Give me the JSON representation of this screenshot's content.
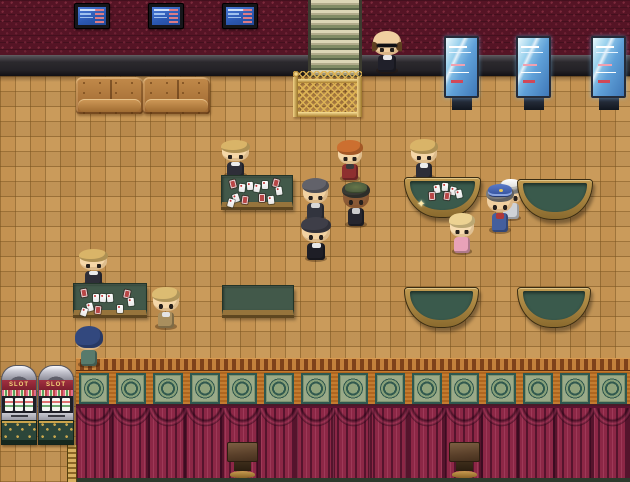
{
  "scene": {
    "width": 630,
    "height": 482
  },
  "labels": {
    "slot": "SLOT",
    "sparkle": "✦"
  },
  "palette": {
    "wall": "#551425",
    "floor": "#c49251",
    "curtain": "#8c2746",
    "table_felt": "#42594a",
    "gold_trim": "#c9a34c",
    "entrance_green": "#76815c",
    "entrance_cream": "#d8d2b2",
    "screen_blue": "#3a6fd8"
  },
  "fixtures": {
    "tvs": [
      {
        "x": 74,
        "y": 3
      },
      {
        "x": 148,
        "y": 3
      },
      {
        "x": 222,
        "y": 3
      }
    ],
    "tv_size": {
      "w": 36,
      "h": 26
    },
    "kiosks": [
      {
        "x": 444,
        "y": 36
      },
      {
        "x": 516,
        "y": 36
      },
      {
        "x": 591,
        "y": 36
      }
    ],
    "kiosk_size": {
      "w": 35,
      "h": 76
    },
    "couches": [
      {
        "x": 76,
        "y": 77
      },
      {
        "x": 143,
        "y": 77
      }
    ],
    "couch_size": {
      "w": 67,
      "h": 37
    },
    "slot_machines": [
      {
        "x": 1,
        "y": 365
      },
      {
        "x": 38,
        "y": 365
      }
    ],
    "slot_size": {
      "w": 36,
      "h": 80
    },
    "podiums": [
      {
        "x": 227,
        "y": 442
      },
      {
        "x": 449,
        "y": 442
      }
    ],
    "podium_size": {
      "w": 31,
      "h": 36
    },
    "frieze_panels": 15
  },
  "tables": [
    {
      "id": "card-table-north",
      "type": "rect",
      "x": 221,
      "y": 175,
      "w": 72,
      "h": 32,
      "cards": [
        {
          "x": 8,
          "y": 4,
          "c": "r",
          "rot": -14
        },
        {
          "x": 17,
          "y": 8,
          "c": "w",
          "rot": 6
        },
        {
          "x": 25,
          "y": 6,
          "c": "w",
          "rot": -4
        },
        {
          "x": 32,
          "y": 8,
          "c": "w",
          "rot": 10
        },
        {
          "x": 40,
          "y": 5,
          "c": "w",
          "rot": 0
        },
        {
          "x": 51,
          "y": 3,
          "c": "r",
          "rot": 14
        },
        {
          "x": 54,
          "y": 11,
          "c": "w",
          "rot": -8
        },
        {
          "x": 11,
          "y": 18,
          "c": "w",
          "rot": -18
        },
        {
          "x": 20,
          "y": 20,
          "c": "r",
          "rot": 8
        },
        {
          "x": 37,
          "y": 18,
          "c": "r",
          "rot": 0
        },
        {
          "x": 6,
          "y": 23,
          "c": "w",
          "rot": 16
        },
        {
          "x": 46,
          "y": 20,
          "c": "w",
          "rot": -6
        }
      ]
    },
    {
      "id": "card-table-south",
      "type": "rect",
      "x": 73,
      "y": 283,
      "w": 74,
      "h": 32,
      "cards": [
        {
          "x": 7,
          "y": 5,
          "c": "r",
          "rot": -10
        },
        {
          "x": 19,
          "y": 10,
          "c": "w",
          "rot": 0
        },
        {
          "x": 26,
          "y": 10,
          "c": "w",
          "rot": 4
        },
        {
          "x": 33,
          "y": 10,
          "c": "w",
          "rot": -4
        },
        {
          "x": 50,
          "y": 6,
          "c": "r",
          "rot": 12
        },
        {
          "x": 54,
          "y": 14,
          "c": "w",
          "rot": -6
        },
        {
          "x": 13,
          "y": 19,
          "c": "w",
          "rot": -14
        },
        {
          "x": 21,
          "y": 22,
          "c": "r",
          "rot": 6
        },
        {
          "x": 43,
          "y": 21,
          "c": "w",
          "rot": 0
        },
        {
          "x": 7,
          "y": 24,
          "c": "w",
          "rot": 18
        }
      ]
    },
    {
      "id": "empty-table-center",
      "type": "rect",
      "x": 222,
      "y": 285,
      "w": 72,
      "h": 30,
      "cards": []
    },
    {
      "id": "blackjack-table-dealt",
      "type": "halfmoon",
      "x": 404,
      "y": 177,
      "w": 77,
      "h": 41,
      "sparkle": {
        "x": 12,
        "y": 22
      },
      "cards": [
        {
          "x": 29,
          "y": 7,
          "c": "w",
          "rot": -8
        },
        {
          "x": 37,
          "y": 5,
          "c": "w",
          "rot": 4
        },
        {
          "x": 45,
          "y": 9,
          "c": "w",
          "rot": 12
        },
        {
          "x": 24,
          "y": 14,
          "c": "r",
          "rot": -4
        },
        {
          "x": 39,
          "y": 14,
          "c": "r",
          "rot": 8
        },
        {
          "x": 51,
          "y": 12,
          "c": "w",
          "rot": -12
        }
      ]
    },
    {
      "id": "blackjack-table-ne",
      "type": "halfmoon",
      "x": 517,
      "y": 179,
      "w": 76,
      "h": 41,
      "cards": []
    },
    {
      "id": "blackjack-table-sw",
      "type": "halfmoon",
      "x": 404,
      "y": 287,
      "w": 75,
      "h": 41,
      "cards": []
    },
    {
      "id": "blackjack-table-se",
      "type": "halfmoon",
      "x": 517,
      "y": 287,
      "w": 74,
      "h": 41,
      "cards": []
    }
  ],
  "characters": [
    {
      "id": "doorman",
      "x": 372,
      "y": 31,
      "w": 30,
      "h": 43,
      "skin": "#f0cfa0",
      "hair": null,
      "outfit": "#20202a",
      "shirt": "#e8e8e8",
      "acc": [
        "bald-sides",
        "sunglasses"
      ]
    },
    {
      "id": "dealer-north",
      "x": 221,
      "y": 141,
      "w": 29,
      "h": 37,
      "skin": "#f5d7a8",
      "hair": "#d9b468",
      "outfit": "#2e2e38",
      "shirt": "#ececec"
    },
    {
      "id": "guest-red-jacket",
      "x": 337,
      "y": 141,
      "w": 26,
      "h": 41,
      "skin": "#f5d7a8",
      "hair": "#cc6f30",
      "outfit": "#8e2f2f",
      "shirt": "#3a3a3a"
    },
    {
      "id": "guest-grey-hair",
      "x": 302,
      "y": 179,
      "w": 27,
      "h": 43,
      "skin": "#f2d2a2",
      "hair": "#62626a",
      "outfit": "#32343e",
      "shirt": "#d8d8d8"
    },
    {
      "id": "guest-green-cap",
      "x": 342,
      "y": 183,
      "w": 28,
      "h": 45,
      "skin": "#8a5a36",
      "hair": "#3a3a34",
      "outfit": "#26262e",
      "shirt": "#cccccc",
      "acc": [
        "cap-green"
      ]
    },
    {
      "id": "guest-black-suit",
      "x": 301,
      "y": 218,
      "w": 30,
      "h": 44,
      "skin": "#f2d2a2",
      "hair": "#3e3e48",
      "outfit": "#1e1e26",
      "shirt": "#e8e8e8"
    },
    {
      "id": "dealer-blackjack",
      "x": 410,
      "y": 140,
      "w": 28,
      "h": 41,
      "skin": "#f5d7a8",
      "hair": "#d9b468",
      "outfit": "#2e2e38",
      "shirt": "#ececec"
    },
    {
      "id": "guest-white-hat",
      "x": 498,
      "y": 181,
      "w": 26,
      "h": 40,
      "skin": "#f0cfa0",
      "hair": "#9a9a98",
      "outfit": "#cfd2d6",
      "acc": [
        "hat-white"
      ]
    },
    {
      "id": "guest-blue-cap",
      "x": 486,
      "y": 186,
      "w": 28,
      "h": 48,
      "skin": "#f0cfa0",
      "hair": "#7a7a7a",
      "outfit": "#445f9e",
      "shirt": "#b03838",
      "acc": [
        "cap-blue"
      ]
    },
    {
      "id": "child-pink",
      "x": 449,
      "y": 214,
      "w": 26,
      "h": 41,
      "skin": "#f7dcb0",
      "hair": "#ecd292",
      "outfit": "#e8a2b8"
    },
    {
      "id": "dealer-south",
      "x": 79,
      "y": 250,
      "w": 29,
      "h": 37,
      "skin": "#f5d7a8",
      "hair": "#d9b468",
      "outfit": "#2e2e38",
      "shirt": "#ececec"
    },
    {
      "id": "guest-blonde",
      "x": 152,
      "y": 288,
      "w": 28,
      "h": 42,
      "skin": "#f5d7a8",
      "hair": "#dcbc72",
      "outfit": "#a98f5e",
      "shirt": "#e4e4e4"
    },
    {
      "id": "player",
      "x": 75,
      "y": 327,
      "w": 28,
      "h": 41,
      "skin": "#f0cfa0",
      "hair": "#32487e",
      "outfit": "#587a6c",
      "facing": "back"
    }
  ]
}
